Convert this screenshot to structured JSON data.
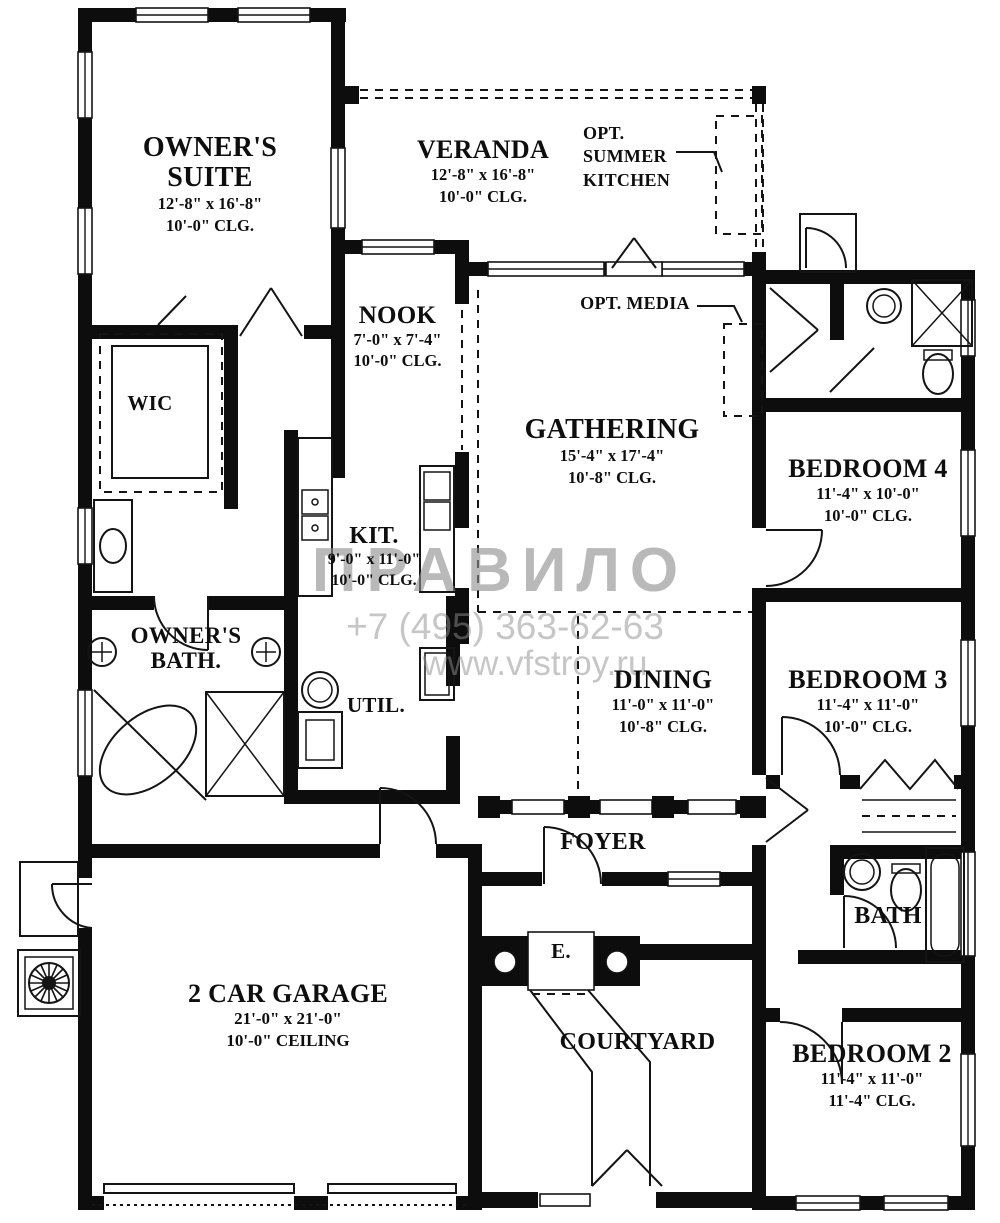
{
  "watermark": {
    "brand": "ПРАВИЛО",
    "phone": "+7 (495) 363-62-63",
    "site": "www.vfstroy.ru"
  },
  "rooms": {
    "owners_suite": {
      "name": "OWNER'S SUITE",
      "size": "12'-8\" x 16'-8\"",
      "ceiling": "10'-0\" CLG."
    },
    "veranda": {
      "name": "VERANDA",
      "size": "12'-8\" x 16'-8\"",
      "ceiling": "10'-0\" CLG."
    },
    "opt_summer_kitchen": {
      "name": "OPT. SUMMER KITCHEN"
    },
    "opt_media": {
      "name": "OPT. MEDIA"
    },
    "nook": {
      "name": "NOOK",
      "size": "7'-0\" x 7'-4\"",
      "ceiling": "10'-0\" CLG."
    },
    "gathering": {
      "name": "GATHERING",
      "size": "15'-4\" x 17'-4\"",
      "ceiling": "10'-8\" CLG."
    },
    "bedroom4": {
      "name": "BEDROOM 4",
      "size": "11'-4\" x 10'-0\"",
      "ceiling": "10'-0\" CLG."
    },
    "wic": {
      "name": "WIC"
    },
    "kitchen": {
      "name": "KIT.",
      "size": "9'-0\" x 11'-0\"",
      "ceiling": "10'-0\" CLG."
    },
    "owners_bath": {
      "name": "OWNER'S BATH."
    },
    "util": {
      "name": "UTIL."
    },
    "dining": {
      "name": "DINING",
      "size": "11'-0\" x 11'-0\"",
      "ceiling": "10'-8\" CLG."
    },
    "bedroom3": {
      "name": "BEDROOM 3",
      "size": "11'-4\" x 11'-0\"",
      "ceiling": "10'-0\" CLG."
    },
    "foyer": {
      "name": "FOYER"
    },
    "entry": {
      "name": "E."
    },
    "bath": {
      "name": "BATH"
    },
    "garage": {
      "name": "2 CAR GARAGE",
      "size": "21'-0\" x 21'-0\"",
      "ceiling": "10'-0\" CEILING"
    },
    "courtyard": {
      "name": "COURTYARD"
    },
    "bedroom2": {
      "name": "BEDROOM 2",
      "size": "11'-4\" x 11'-0\"",
      "ceiling": "11'-4\" CLG."
    }
  }
}
